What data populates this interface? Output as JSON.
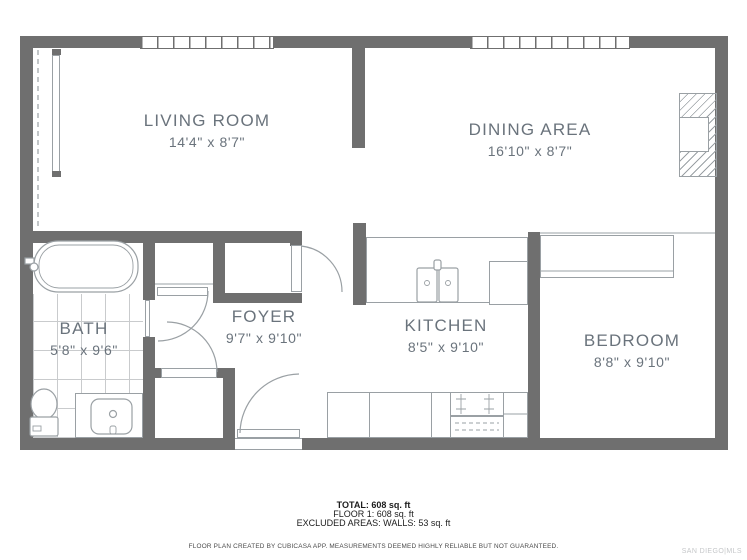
{
  "plan": {
    "rooms": [
      {
        "id": "living-room",
        "label": "LIVING ROOM",
        "dims": "14'4\" x 8'7\""
      },
      {
        "id": "dining-area",
        "label": "DINING AREA",
        "dims": "16'10\" x 8'7\""
      },
      {
        "id": "bath",
        "label": "BATH",
        "dims": "5'8\" x 9'6\""
      },
      {
        "id": "foyer",
        "label": "FOYER",
        "dims": "9'7\" x 9'10\""
      },
      {
        "id": "kitchen",
        "label": "KITCHEN",
        "dims": "8'5\" x 9'10\""
      },
      {
        "id": "bedroom",
        "label": "BEDROOM",
        "dims": "8'8\" x 9'10\""
      }
    ],
    "summary": {
      "total": "TOTAL: 608 sq. ft",
      "floor": "FLOOR 1: 608 sq. ft",
      "excluded": "EXCLUDED AREAS: WALLS: 53 sq. ft"
    },
    "disclaimer": "FLOOR PLAN CREATED BY CUBICASA APP. MEASUREMENTS DEEMED HIGHLY RELIABLE BUT NOT GUARANTEED.",
    "watermark": "SAN DIEGO|MLS",
    "colors": {
      "wall": "#6f6f6f",
      "label": "#6a737c",
      "line": "#9aa0a4",
      "tile": "#c9cbcd",
      "ink": "#1c1c1c",
      "disc": "#4a4a4a",
      "watermark": "#c5c7c9"
    }
  }
}
